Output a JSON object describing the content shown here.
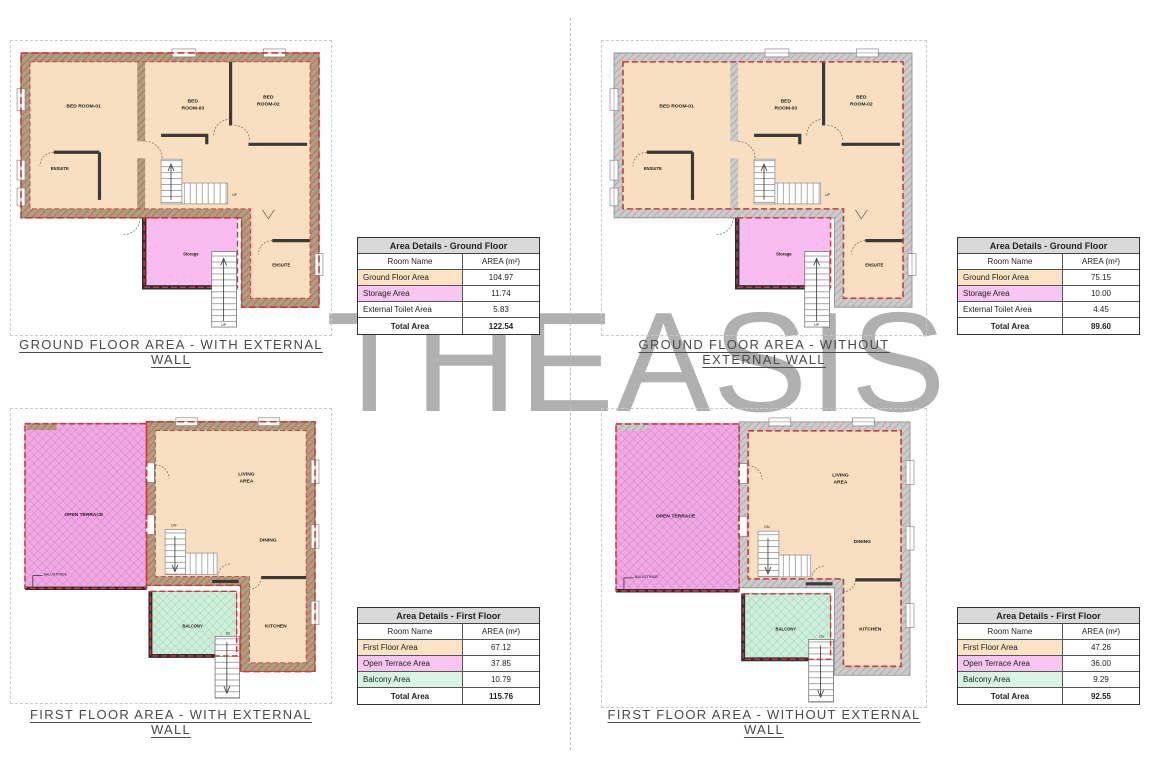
{
  "watermark": "THEASIS",
  "colors": {
    "room_fill": "#f8dfc0",
    "wall_with_external": "#b49c7f",
    "wall_without_external": "#cbcbcb",
    "storage_fill": "#f9bcf0",
    "open_terrace_fill": "#efa9e4",
    "balcony_fill": "#cdeeda",
    "area_boundary_red": "#d43535",
    "table_header_bg": "#d9d9d9",
    "table_row_floor": "#fbe3c3",
    "table_row_storage_terrace": "#f9c6f2",
    "table_row_balcony": "#d8f5e3",
    "watermark_gray": "#b0b0b0"
  },
  "ground_plan_labels": {
    "bed1": "BED ROOM-01",
    "bed3a": "BED",
    "bed3b": "ROOM-03",
    "bed2a": "BED",
    "bed2b": "ROOM-02",
    "ensuite": "ENSUITE",
    "ensuite2": "ENSUITE",
    "storage": "Storage",
    "up": "UP",
    "up2": "UP"
  },
  "first_plan_labels": {
    "terrace": "OPEN TERRACE",
    "livinga": "LIVING",
    "livingb": "AREA",
    "dining": "DINING",
    "kitchen": "KITCHEN",
    "balcony": "BALCONY",
    "balustrade": "BALUSTRADE",
    "dn": "DN",
    "dn2": "Dn"
  },
  "panels": {
    "ground_with": {
      "caption": "GROUND FLOOR AREA - WITH EXTERNAL WALL",
      "table": {
        "title": "Area Details - Ground Floor",
        "col_room": "Room Name",
        "col_area": "AREA (m²)",
        "rows": [
          {
            "name": "Ground Floor Area",
            "area": "104.97"
          },
          {
            "name": "Storage Area",
            "area": "11.74"
          },
          {
            "name": "External Toilet Area",
            "area": "5.83"
          }
        ],
        "total_label": "Total Area",
        "total": "122.54"
      }
    },
    "ground_without": {
      "caption": "GROUND FLOOR AREA - WITHOUT EXTERNAL WALL",
      "table": {
        "title": "Area Details - Ground Floor",
        "col_room": "Room Name",
        "col_area": "AREA (m²)",
        "rows": [
          {
            "name": "Ground Floor Area",
            "area": "75.15"
          },
          {
            "name": "Storage Area",
            "area": "10.00"
          },
          {
            "name": "External Toilet Area",
            "area": "4.45"
          }
        ],
        "total_label": "Total Area",
        "total": "89.60"
      }
    },
    "first_with": {
      "caption": "FIRST FLOOR AREA - WITH EXTERNAL WALL",
      "table": {
        "title": "Area Details - First Floor",
        "col_room": "Room Name",
        "col_area": "AREA (m²)",
        "rows": [
          {
            "name": "First Floor Area",
            "area": "67.12"
          },
          {
            "name": "Open Terrace Area",
            "area": "37.85"
          },
          {
            "name": "Balcony Area",
            "area": "10.79"
          }
        ],
        "total_label": "Total Area",
        "total": "115.76"
      }
    },
    "first_without": {
      "caption": "FIRST FLOOR AREA - WITHOUT EXTERNAL WALL",
      "table": {
        "title": "Area Details - First Floor",
        "col_room": "Room Name",
        "col_area": "AREA (m²)",
        "rows": [
          {
            "name": "First Floor Area",
            "area": "47.26"
          },
          {
            "name": "Open Terrace Area",
            "area": "36.00"
          },
          {
            "name": "Balcony Area",
            "area": "9.29"
          }
        ],
        "total_label": "Total Area",
        "total": "92.55"
      }
    }
  }
}
